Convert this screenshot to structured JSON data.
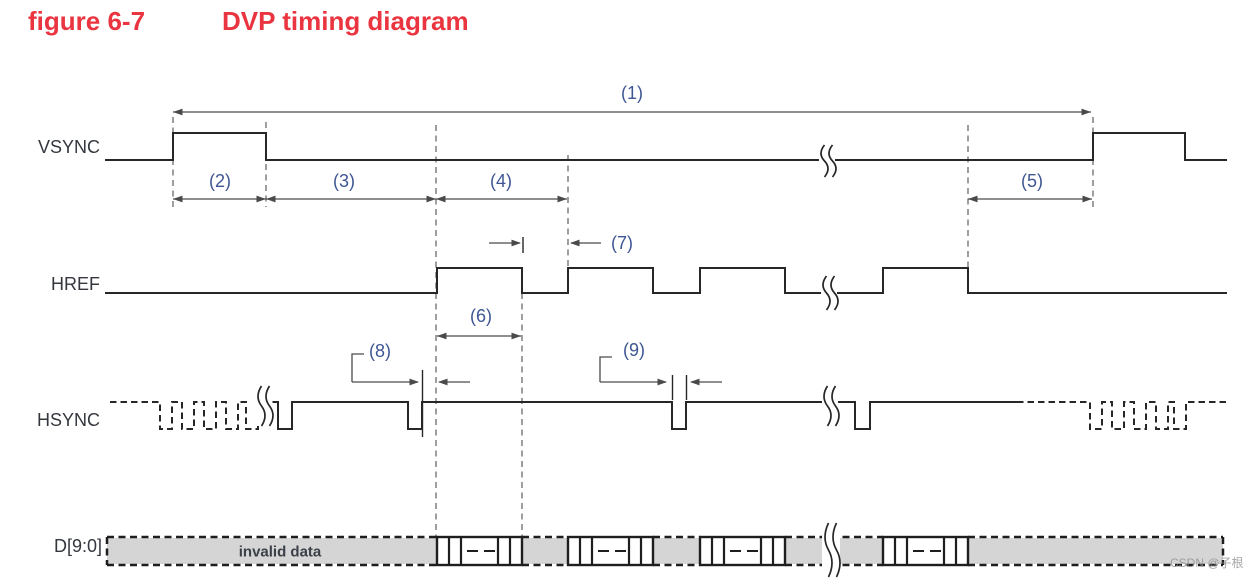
{
  "title": {
    "figure_label": "figure 6-7",
    "title_text": "DVP timing diagram"
  },
  "watermark": {
    "text": "CSDN @子根"
  },
  "colors": {
    "title_red": "#ea3540",
    "signal_line": "#272727",
    "dim_line": "#4a4a4a",
    "dashed_line": "#6b6b6b",
    "number_label": "#3f5694",
    "signal_label": "#34383e",
    "invalid_label": "#3b4048",
    "band_fill": "#d5d5d5",
    "band_border": "#1e1e1e",
    "watermark_color": "#8f8f8f"
  },
  "canvas": {
    "width": 1258,
    "height": 579
  },
  "signal_labels": [
    {
      "id": "vsync",
      "text": "VSYNC",
      "x": 100,
      "y": 147
    },
    {
      "id": "href",
      "text": "HREF",
      "x": 100,
      "y": 284
    },
    {
      "id": "hsync",
      "text": "HSYNC",
      "x": 100,
      "y": 420
    },
    {
      "id": "dbus",
      "text": "D[9:0]",
      "x": 102,
      "y": 546
    }
  ],
  "vsync": {
    "x_start": 105,
    "x_end": 1227,
    "y_low": 160,
    "y_high": 133,
    "pulses": [
      [
        173,
        266
      ],
      [
        1093,
        1185
      ]
    ]
  },
  "href": {
    "x_start": 105,
    "x_end": 1227,
    "y_low": 293,
    "y_high": 268,
    "pulses": [
      [
        437,
        522
      ],
      [
        568,
        653
      ],
      [
        700,
        785
      ],
      [
        883,
        968
      ]
    ]
  },
  "hsync": {
    "y_high": 402,
    "y_low": 429,
    "runs": [
      {
        "style": "dashed",
        "from": 110,
        "to": 258,
        "lows": [
          [
            160,
            172
          ],
          [
            182,
            194
          ],
          [
            204,
            216
          ],
          [
            226,
            238
          ],
          [
            246,
            258
          ]
        ]
      },
      {
        "style": "solid",
        "from": 270,
        "to": 1017,
        "lows": [
          [
            278,
            292
          ],
          [
            408,
            422
          ],
          [
            672,
            686
          ],
          [
            855,
            870
          ]
        ]
      },
      {
        "style": "dashed",
        "from": 1017,
        "to": 1227,
        "lows": [
          [
            1090,
            1102
          ],
          [
            1112,
            1124
          ],
          [
            1134,
            1146
          ],
          [
            1156,
            1168
          ],
          [
            1174,
            1186
          ]
        ]
      }
    ]
  },
  "dbus": {
    "x_start": 107,
    "x_end": 1223,
    "y_top": 537,
    "y_bottom": 565,
    "invalid_label": {
      "text": "invalid data",
      "x": 280,
      "y": 552
    },
    "gray_segments": [
      [
        107,
        437
      ],
      [
        522,
        568
      ],
      [
        653,
        700
      ],
      [
        785,
        883
      ],
      [
        968,
        1223
      ]
    ],
    "blocks": [
      [
        437,
        522
      ],
      [
        568,
        653
      ],
      [
        700,
        785
      ],
      [
        883,
        968
      ]
    ],
    "divider_offsets": [
      12,
      24,
      61,
      73
    ],
    "dash_cells": [
      [
        30,
        41
      ],
      [
        47,
        58
      ]
    ]
  },
  "dimensions": [
    {
      "label": "(1)",
      "x1": 173,
      "x2": 1091,
      "y": 112,
      "label_x": 632,
      "label_y": 93
    },
    {
      "label": "(2)",
      "x1": 173,
      "x2": 266,
      "y": 199,
      "label_x": 220,
      "label_y": 181
    },
    {
      "label": "(3)",
      "x1": 266,
      "x2": 436,
      "y": 199,
      "label_x": 344,
      "label_y": 181
    },
    {
      "label": "(4)",
      "x1": 436,
      "x2": 567,
      "y": 199,
      "label_x": 501,
      "label_y": 181
    },
    {
      "label": "(5)",
      "x1": 968,
      "x2": 1092,
      "y": 199,
      "label_x": 1032,
      "label_y": 181
    },
    {
      "label": "(6)",
      "x1": 437,
      "x2": 521,
      "y": 336,
      "label_x": 481,
      "label_y": 316
    }
  ],
  "gap_dimensions": [
    {
      "label": "(7)",
      "tip1": 521,
      "tail1": 489,
      "tip2": 570,
      "tail2": 601,
      "y": 243,
      "label_x": 622,
      "label_y": 243,
      "leader": null
    },
    {
      "label": "(8)",
      "tip1": 419,
      "tail1": 352,
      "tip2": 438,
      "tail2": 470,
      "y": 382,
      "label_x": 380,
      "label_y": 351,
      "leader": {
        "x": 352,
        "y_top": 354,
        "nub": 12
      }
    },
    {
      "label": "(9)",
      "tip1": 667,
      "tail1": 600,
      "tip2": 690,
      "tail2": 722,
      "y": 382,
      "label_x": 634,
      "label_y": 350,
      "leader": {
        "x": 600,
        "y_top": 357,
        "nub": 12
      }
    }
  ],
  "extension_dashed_lines": [
    {
      "x": 173,
      "y1": 117,
      "y2": 207
    },
    {
      "x": 266,
      "y1": 122,
      "y2": 207
    },
    {
      "x": 436,
      "y1": 125,
      "y2": 537
    },
    {
      "x": 522,
      "y1": 293,
      "y2": 537
    },
    {
      "x": 568,
      "y1": 155,
      "y2": 293
    },
    {
      "x": 968,
      "y1": 125,
      "y2": 293
    },
    {
      "x": 1093,
      "y1": 117,
      "y2": 207
    }
  ],
  "solid_ticks": [
    {
      "x": 523,
      "y1": 237,
      "y2": 253
    },
    {
      "x": 422.5,
      "y1": 370,
      "y2": 437
    },
    {
      "x": 672.5,
      "y1": 375,
      "y2": 400
    },
    {
      "x": 686.5,
      "y1": 375,
      "y2": 400
    }
  ],
  "breaks": [
    {
      "id": "vsync-break",
      "x": 827,
      "y1": 145,
      "y2": 177,
      "w": 16
    },
    {
      "id": "href-break",
      "x": 829,
      "y1": 276,
      "y2": 310,
      "w": 16
    },
    {
      "id": "hsync-break-left",
      "x": 264,
      "y1": 386,
      "y2": 426,
      "w": 17
    },
    {
      "id": "hsync-break-right",
      "x": 830,
      "y1": 386,
      "y2": 426,
      "w": 16
    },
    {
      "id": "dbus-break",
      "x": 831,
      "y1": 523,
      "y2": 577,
      "w": 18
    }
  ]
}
